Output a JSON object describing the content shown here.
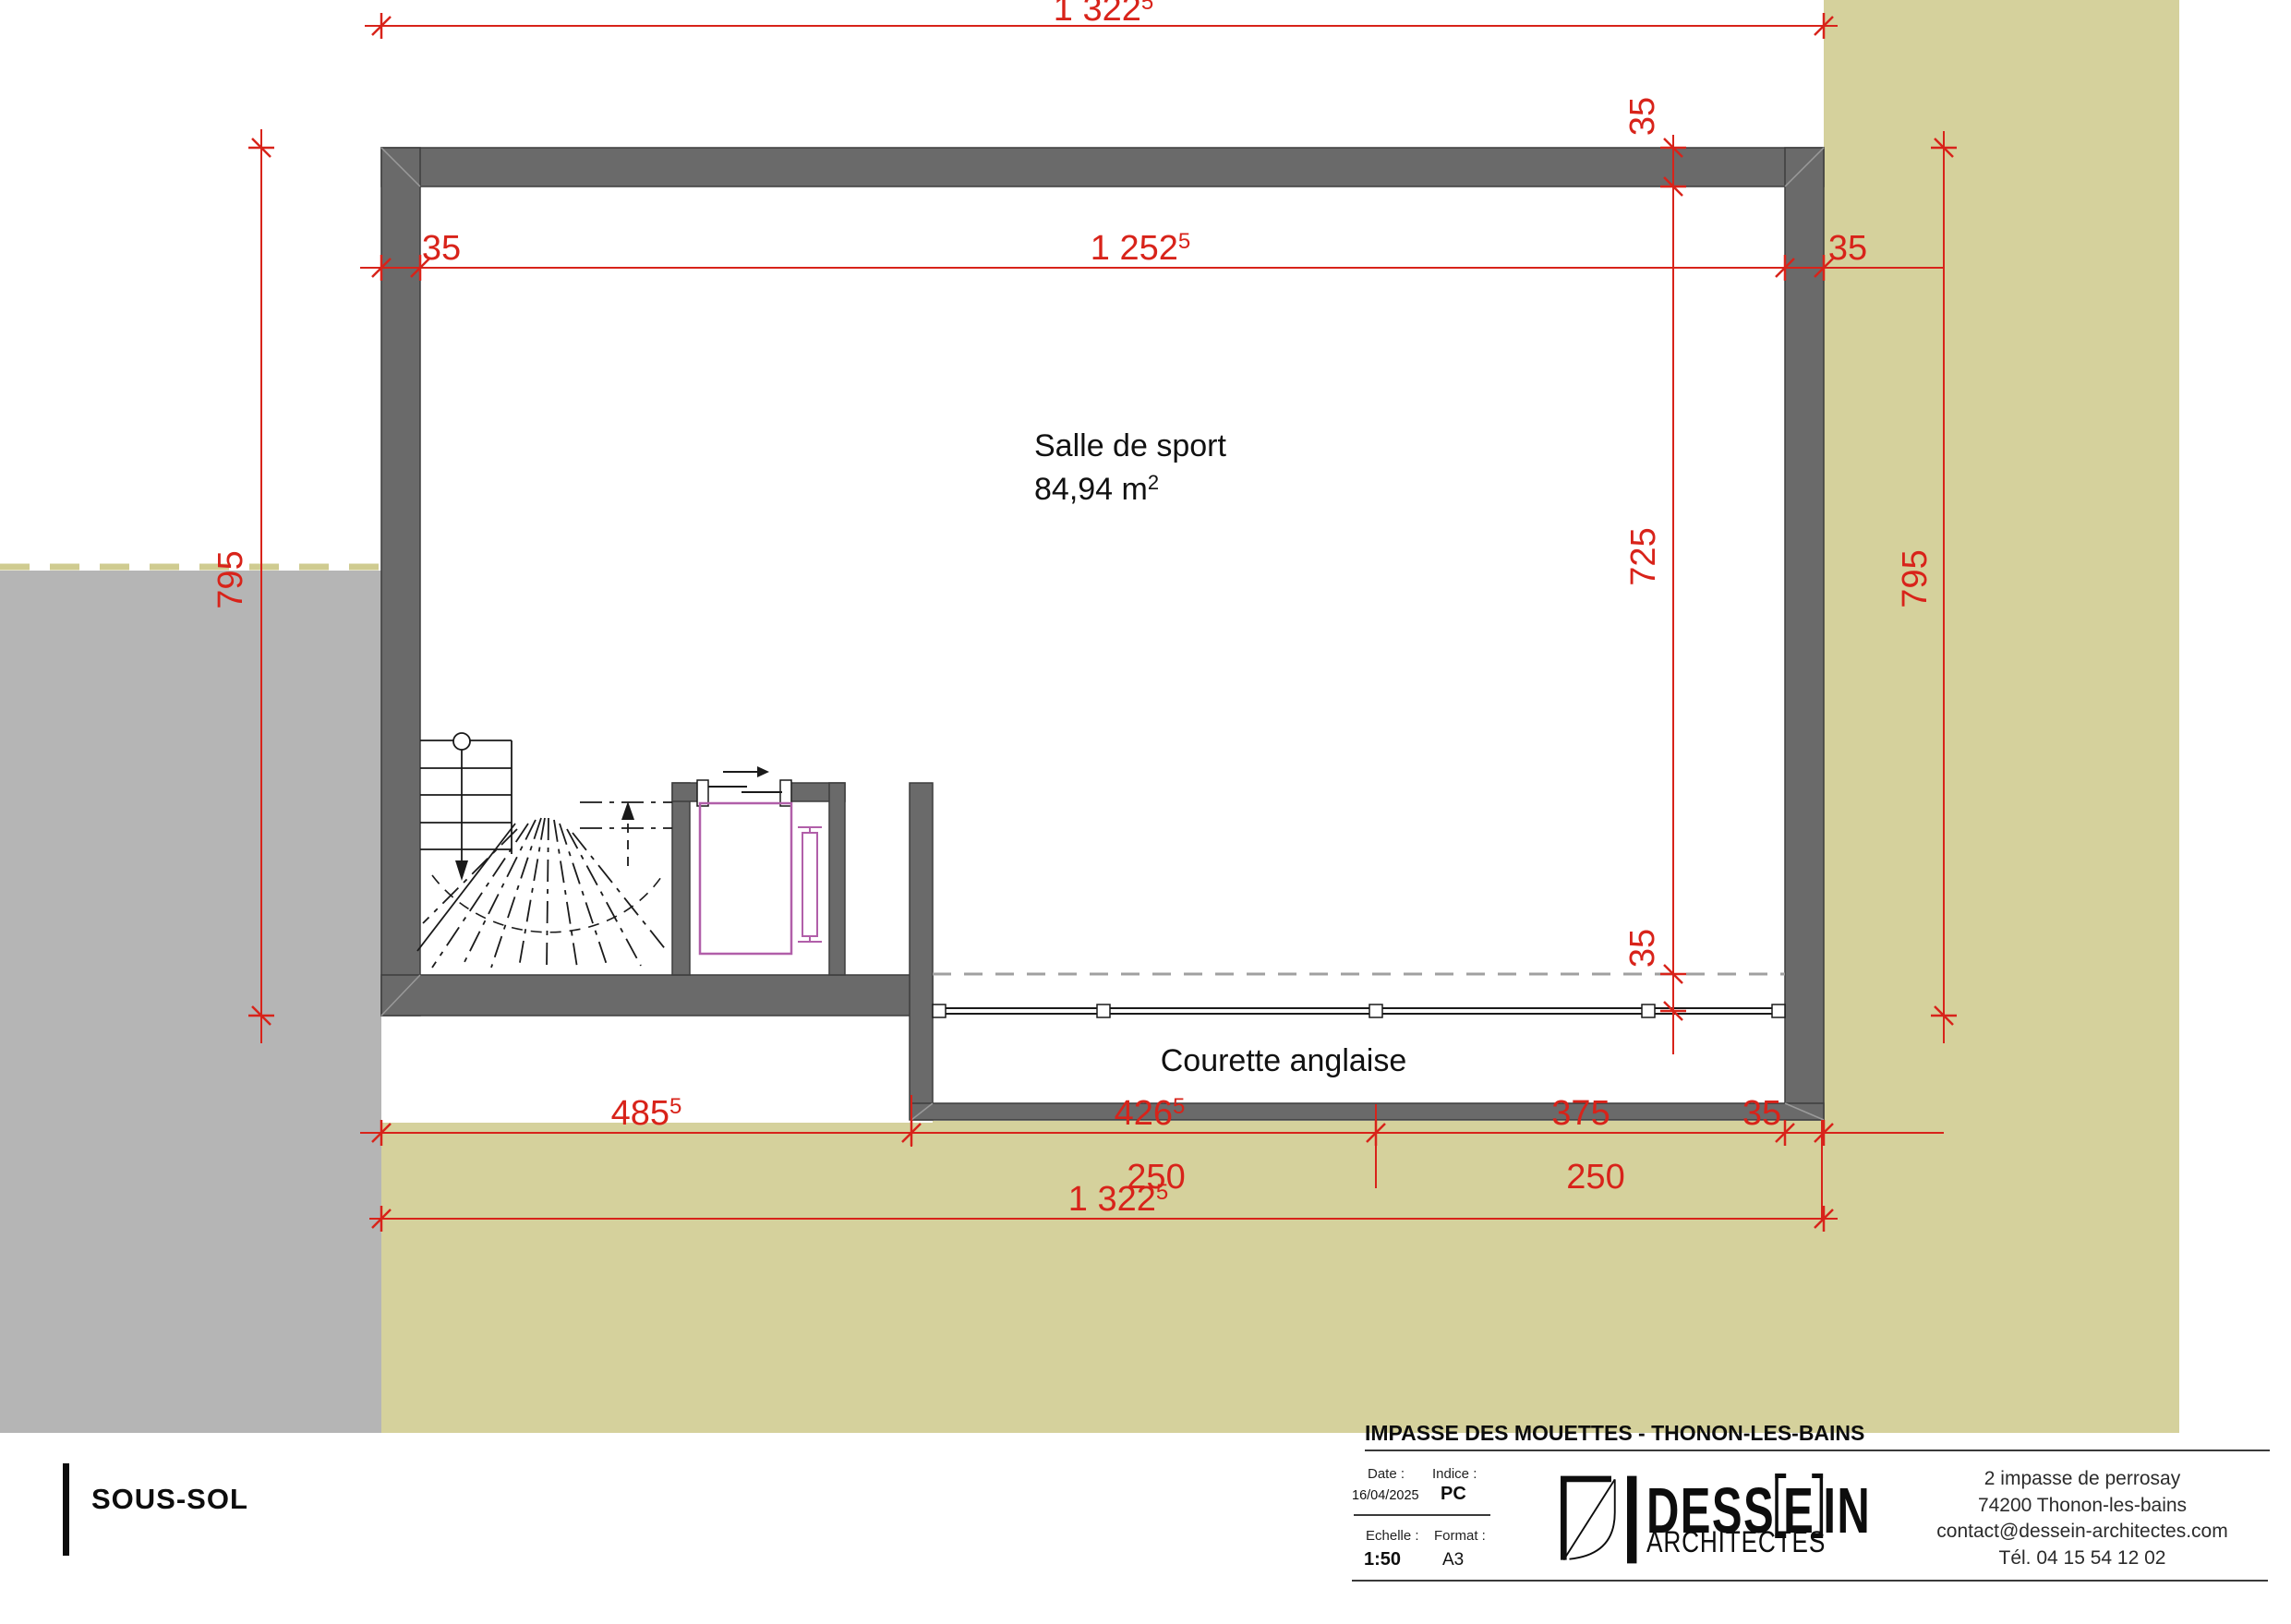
{
  "plan": {
    "room": {
      "name": "Salle de sport",
      "area": "84,94 m",
      "area_sup": "2"
    },
    "courette_label": "Courette anglaise",
    "dims": {
      "top_total": "1 322",
      "top_total_sup": "5",
      "inner_width": "1 252",
      "inner_width_sup": "5",
      "wall_left": "35",
      "wall_right": "35",
      "wall_top": "35",
      "wall_bottom": "35",
      "height_left": "795",
      "height_right": "795",
      "inner_height": "725",
      "seg1": "485",
      "seg1_sup": "5",
      "seg2": "426",
      "seg2_sup": "5",
      "seg3": "375",
      "seg4": "35",
      "win1": "250",
      "win2": "250",
      "bottom_total": "1 322",
      "bottom_total_sup": "5"
    },
    "colors": {
      "dimension_red": "#d8231a",
      "wall_gray": "#6a6a6a",
      "terrain_khaki": "#d5d19c",
      "terrain_gray": "#b5b5b5",
      "elevator_magenta": "#b15fa9"
    }
  },
  "title_block": {
    "drawing_name": "SOUS-SOL",
    "project_title": "IMPASSE DES MOUETTES - THONON-LES-BAINS",
    "date_label": "Date :",
    "date_value": "16/04/2025",
    "indice_label": "Indice :",
    "indice_value": "PC",
    "scale_label": "Echelle :",
    "scale_value": "1:50",
    "format_label": "Format :",
    "format_value": "A3",
    "logo": {
      "part1": "DESS",
      "part2": "E",
      "part3": "IN",
      "subtitle": "ARCHITECTES"
    },
    "contact": {
      "line1": "2 impasse de perrosay",
      "line2": "74200 Thonon-les-bains",
      "line3": "contact@dessein-architectes.com",
      "line4": "Tél. 04 15 54 12 02"
    }
  }
}
